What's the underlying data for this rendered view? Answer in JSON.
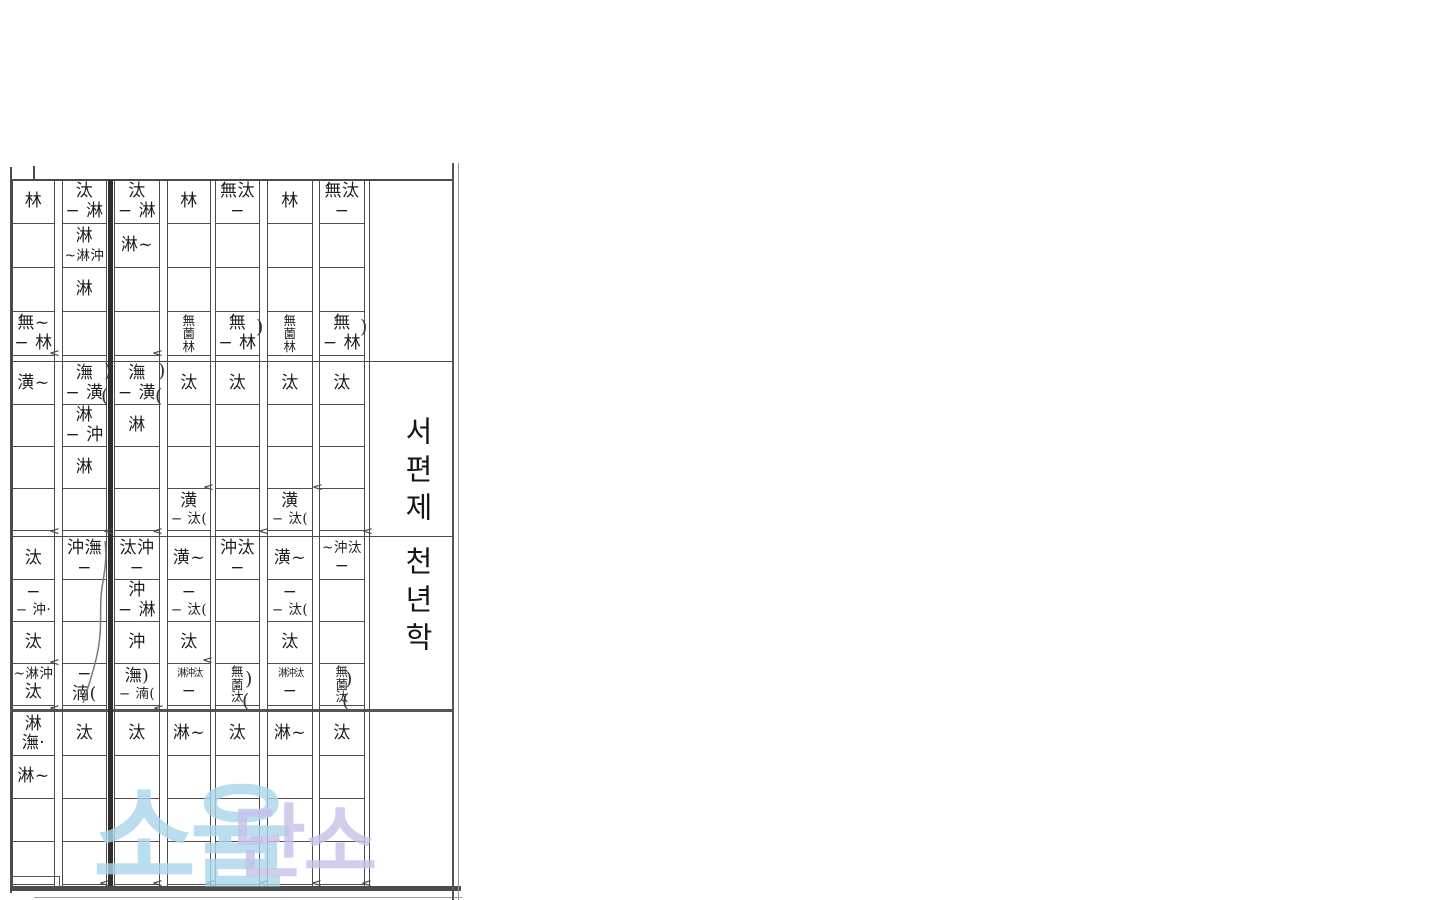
{
  "page": {
    "background": "#ffffff",
    "line_color": "#4b4b4b"
  },
  "title": {
    "line1": "서편제",
    "line2": "천년학"
  },
  "watermark": {
    "left_text": "소율",
    "left_color": "#a9d7e9",
    "right_text": "단소",
    "right_color": "#c7c1e9"
  },
  "notation": {
    "row_count": 16,
    "columns": [
      {
        "name": "column-1",
        "cells": {
          "1": {
            "lines": [
              "林"
            ]
          },
          "4": {
            "lines": [
              "無~",
              "− 林"
            ]
          },
          "5": {
            "lines": [
              "潢~"
            ]
          },
          "9": {
            "lines": [
              "汰"
            ]
          },
          "10": {
            "lines": [
              "−",
              "− 沖·"
            ]
          },
          "11": {
            "lines": [
              "汰"
            ]
          },
          "12": {
            "lines": [
              "~淋沖",
              "汰"
            ]
          },
          "13": {
            "lines": [
              "淋",
              "潕·"
            ]
          },
          "14": {
            "lines": [
              "淋~"
            ]
          }
        }
      },
      {
        "name": "column-2",
        "cells": {
          "1": {
            "lines": [
              "汰",
              "− 淋"
            ]
          },
          "2": {
            "lines": [
              "淋",
              "~淋沖"
            ]
          },
          "3": {
            "lines": [
              "淋"
            ]
          },
          "5": {
            "lines": [
              "潕",
              "− 潢"
            ]
          },
          "6": {
            "lines": [
              "淋",
              "− 沖"
            ]
          },
          "7": {
            "lines": [
              "淋"
            ]
          },
          "9": {
            "lines": [
              "沖潕",
              "−"
            ]
          },
          "12": {
            "lines": [
              "−",
              "湳("
            ]
          },
          "13": {
            "lines": [
              "汰"
            ]
          }
        }
      },
      {
        "name": "column-3",
        "cells": {
          "1": {
            "lines": [
              "汰",
              "− 淋"
            ]
          },
          "2": {
            "lines": [
              "淋~"
            ]
          },
          "5": {
            "lines": [
              "潕",
              "− 潢"
            ]
          },
          "6": {
            "lines": [
              "淋"
            ]
          },
          "9": {
            "lines": [
              "汰沖",
              "−"
            ]
          },
          "10": {
            "lines": [
              "沖",
              "− 淋"
            ]
          },
          "11": {
            "lines": [
              "沖"
            ]
          },
          "12": {
            "lines": [
              "潕)",
              "− 湳("
            ]
          },
          "13": {
            "lines": [
              "汰"
            ]
          }
        }
      },
      {
        "name": "column-4",
        "cells": {
          "1": {
            "lines": [
              "林"
            ]
          },
          "4": {
            "lines": [
              "無",
              "薗",
              "林"
            ],
            "style": "stack"
          },
          "5": {
            "lines": [
              "汰"
            ]
          },
          "8": {
            "lines": [
              "潢",
              "− 汰("
            ]
          },
          "9": {
            "lines": [
              "潢~"
            ]
          },
          "10": {
            "lines": [
              "−",
              "− 汰("
            ]
          },
          "11": {
            "lines": [
              "汰"
            ]
          },
          "12": {
            "lines": [
              "淋沖汰",
              "−"
            ],
            "style": "compress"
          },
          "13": {
            "lines": [
              "淋~"
            ]
          }
        }
      },
      {
        "name": "column-5",
        "cells": {
          "1": {
            "lines": [
              "無汰",
              "−"
            ]
          },
          "4": {
            "lines": [
              "無",
              "− 林"
            ]
          },
          "5": {
            "lines": [
              "汰"
            ]
          },
          "9": {
            "lines": [
              "沖汰",
              "−"
            ]
          },
          "12": {
            "lines": [
              "無",
              "薗",
              "汰"
            ],
            "style": "stack"
          },
          "13": {
            "lines": [
              "汰"
            ]
          }
        }
      },
      {
        "name": "column-6",
        "cells": {
          "1": {
            "lines": [
              "林"
            ]
          },
          "4": {
            "lines": [
              "無",
              "薗",
              "林"
            ],
            "style": "stack"
          },
          "5": {
            "lines": [
              "汰"
            ]
          },
          "8": {
            "lines": [
              "潢",
              "− 汰("
            ]
          },
          "9": {
            "lines": [
              "潢~"
            ]
          },
          "10": {
            "lines": [
              "−",
              "− 汰("
            ]
          },
          "11": {
            "lines": [
              "汰"
            ]
          },
          "12": {
            "lines": [
              "淋沖汰",
              "−"
            ],
            "style": "compress"
          },
          "13": {
            "lines": [
              "淋~"
            ]
          }
        }
      },
      {
        "name": "column-7",
        "cells": {
          "1": {
            "lines": [
              "無汰",
              "−"
            ]
          },
          "4": {
            "lines": [
              "無",
              "− 林"
            ]
          },
          "5": {
            "lines": [
              "汰"
            ]
          },
          "9": {
            "lines": [
              "~沖汰",
              "−"
            ]
          },
          "12": {
            "lines": [
              "無",
              "薗",
              "汰"
            ],
            "style": "stack"
          },
          "13": {
            "lines": [
              "汰"
            ]
          }
        }
      }
    ],
    "ornaments": {
      "parens": [
        {
          "glyph": ")",
          "x": 104,
          "y": 360
        },
        {
          "glyph": "(",
          "x": 101,
          "y": 385
        },
        {
          "glyph": ")",
          "x": 158,
          "y": 360
        },
        {
          "glyph": "(",
          "x": 155,
          "y": 385
        },
        {
          "glyph": ")",
          "x": 256,
          "y": 316
        },
        {
          "glyph": ")",
          "x": 360,
          "y": 316
        },
        {
          "glyph": ")",
          "x": 245,
          "y": 668
        },
        {
          "glyph": "(",
          "x": 242,
          "y": 690
        },
        {
          "glyph": ")",
          "x": 345,
          "y": 668
        },
        {
          "glyph": "(",
          "x": 342,
          "y": 690
        }
      ],
      "chevrons": [
        {
          "x": 49,
          "y": 349
        },
        {
          "x": 152,
          "y": 349
        },
        {
          "x": 203,
          "y": 483
        },
        {
          "x": 312,
          "y": 483
        },
        {
          "x": 49,
          "y": 527
        },
        {
          "x": 103,
          "y": 527
        },
        {
          "x": 152,
          "y": 527
        },
        {
          "x": 258,
          "y": 527
        },
        {
          "x": 362,
          "y": 527
        },
        {
          "x": 49,
          "y": 658
        },
        {
          "x": 202,
          "y": 656
        },
        {
          "x": 49,
          "y": 704
        },
        {
          "x": 153,
          "y": 704
        },
        {
          "x": 99,
          "y": 879
        },
        {
          "x": 152,
          "y": 879
        },
        {
          "x": 205,
          "y": 879
        },
        {
          "x": 258,
          "y": 879
        },
        {
          "x": 311,
          "y": 879
        },
        {
          "x": 361,
          "y": 879
        }
      ],
      "chevron_glyph": "<"
    }
  }
}
